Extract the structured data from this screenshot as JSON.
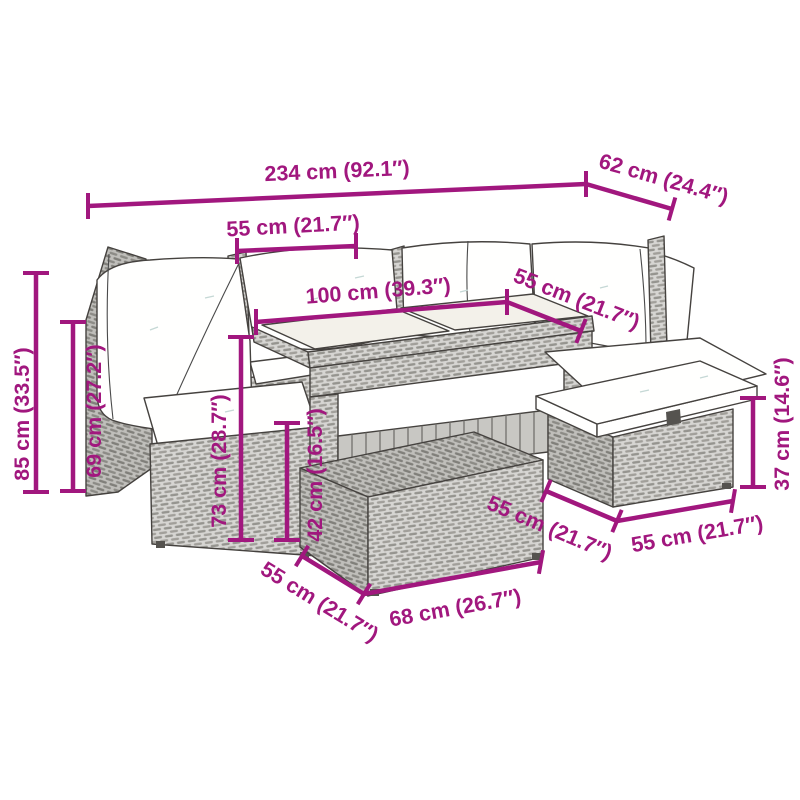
{
  "diagram_type": "furniture-dimension-diagram",
  "colors": {
    "accent": "#a1177e",
    "outline": "#45423f",
    "rattan_light": "#d6d5d2",
    "rattan_dark": "#bfbeba",
    "cushion": "#fffffe",
    "glass": "#f3f1ea",
    "background": "#ffffff"
  },
  "dims": {
    "total_width": {
      "label": "234 cm (92.1″)"
    },
    "total_depth": {
      "label": "62 cm (24.4″)"
    },
    "seat_width": {
      "label": "55 cm (21.7″)"
    },
    "table_length": {
      "label": "100 cm (39.3″)"
    },
    "seat_depth": {
      "label": "55 cm (21.7″)"
    },
    "total_height": {
      "label": "85 cm (33.5″)"
    },
    "armrest_height": {
      "label": "69 cm (27.2″)"
    },
    "table_height": {
      "label": "73 cm (28.7″)"
    },
    "front_stool_height": {
      "label": "42 cm (16.5″)"
    },
    "side_stool_height": {
      "label": "37 cm (14.6″)"
    },
    "front_stool_depth": {
      "label": "55 cm (21.7″)"
    },
    "front_stool_width": {
      "label": "68 cm (26.7″)"
    },
    "side_stool_depth": {
      "label": "55 cm (21.7″)"
    },
    "side_stool_width": {
      "label": "55 cm (21.7″)"
    }
  }
}
